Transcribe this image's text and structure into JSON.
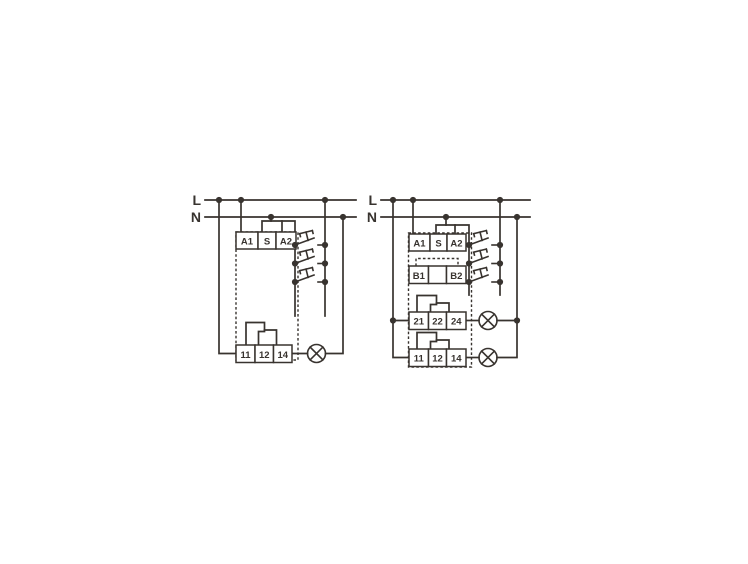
{
  "figure": {
    "description": "Two wiring diagrams for staircase timer relays with push buttons and lamps",
    "colors": {
      "background": "#ffffff",
      "line": "#38332f"
    },
    "left_diagram": {
      "line_labels": {
        "live": "L",
        "neutral": "N"
      },
      "top_terminals": [
        "A1",
        "S",
        "A2"
      ],
      "bottom_terminals": [
        "11",
        "12",
        "14"
      ],
      "push_button_count": 3,
      "lamp_count": 1
    },
    "right_diagram": {
      "line_labels": {
        "live": "L",
        "neutral": "N"
      },
      "top_terminals": [
        "A1",
        "S",
        "A2"
      ],
      "b_terminals": [
        "B1",
        "B2"
      ],
      "output_row_1": [
        "21",
        "22",
        "24"
      ],
      "output_row_2": [
        "11",
        "12",
        "14"
      ],
      "push_button_count": 3,
      "lamp_count": 2
    }
  }
}
